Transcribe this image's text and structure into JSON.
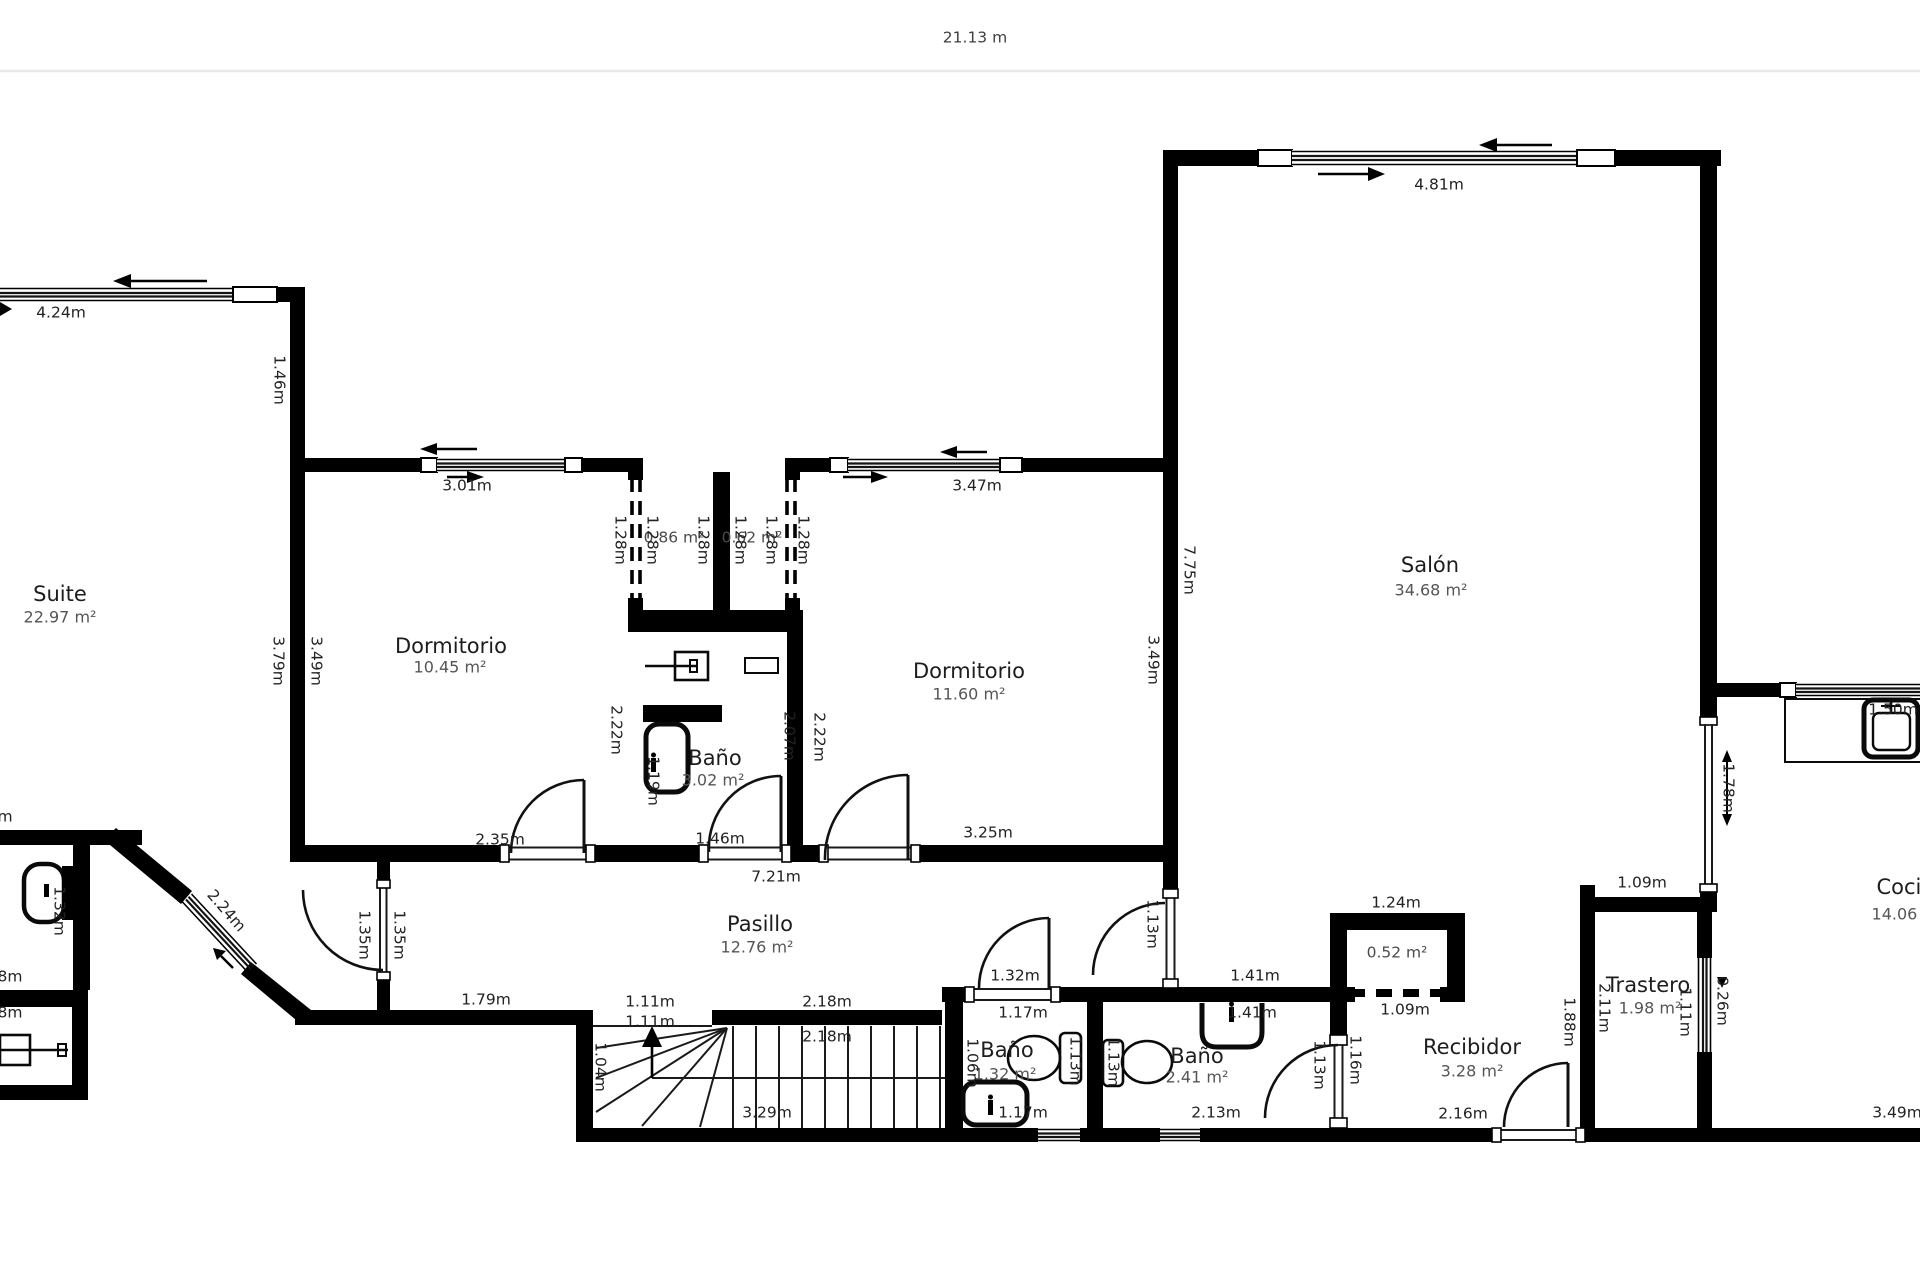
{
  "ruler": {
    "label": "21.13 m"
  },
  "colors": {
    "wall": "#000000",
    "background": "#ffffff",
    "dimension_text": "#222222",
    "area_text": "#555555",
    "ruler_line": "#e8e8e8"
  },
  "rooms": [
    {
      "name": "Suite",
      "area": "22.97 m²",
      "nx": 60,
      "ny": 595,
      "ax": 60,
      "ay": 618
    },
    {
      "name": "Dormitorio",
      "area": "10.45 m²",
      "nx": 451,
      "ny": 647,
      "ax": 450,
      "ay": 668
    },
    {
      "name": "Baño",
      "area": "3.02 m²",
      "nx": 715,
      "ny": 759,
      "ax": 713,
      "ay": 781
    },
    {
      "name": "Dormitorio",
      "area": "11.60 m²",
      "nx": 969,
      "ny": 672,
      "ax": 969,
      "ay": 695
    },
    {
      "name": "Salón",
      "area": "34.68 m²",
      "nx": 1430,
      "ny": 566,
      "ax": 1431,
      "ay": 591
    },
    {
      "name": "Pasillo",
      "area": "12.76 m²",
      "nx": 760,
      "ny": 925,
      "ax": 757,
      "ay": 948
    },
    {
      "name": "Baño",
      "area": "1.32 m²",
      "nx": 1007,
      "ny": 1051,
      "ax": 1005,
      "ay": 1075
    },
    {
      "name": "Baño",
      "area": "2.41 m²",
      "nx": 1197,
      "ny": 1057,
      "ax": 1197,
      "ay": 1078
    },
    {
      "name": "Recibidor",
      "area": "3.28 m²",
      "nx": 1472,
      "ny": 1048,
      "ax": 1472,
      "ay": 1072
    },
    {
      "name": "Trastero",
      "area": "1.98 m²",
      "nx": 1648,
      "ny": 986,
      "ax": 1650,
      "ay": 1009
    },
    {
      "name": "Cocina",
      "area": "14.06 m²",
      "nx": 1912,
      "ny": 888,
      "ax": 1908,
      "ay": 915
    }
  ],
  "closet_areas": [
    {
      "t": "0.86 m²",
      "x": 674,
      "y": 538
    },
    {
      "t": "0.62 m²",
      "x": 752,
      "y": 538
    },
    {
      "t": "0.52 m²",
      "x": 1397,
      "y": 953
    }
  ],
  "dimensions": [
    {
      "t": "4.24m",
      "x": 61,
      "y": 313
    },
    {
      "t": "3.01m",
      "x": 467,
      "y": 486
    },
    {
      "t": "3.47m",
      "x": 977,
      "y": 486
    },
    {
      "t": "4.81m",
      "x": 1439,
      "y": 185
    },
    {
      "t": "2.35m",
      "x": 500,
      "y": 840
    },
    {
      "t": "1.46m",
      "x": 720,
      "y": 839
    },
    {
      "t": "3.25m",
      "x": 988,
      "y": 833
    },
    {
      "t": "7.21m",
      "x": 776,
      "y": 877
    },
    {
      "t": "1.79m",
      "x": 486,
      "y": 1000
    },
    {
      "t": "1.11m",
      "x": 650,
      "y": 1002
    },
    {
      "t": "1.11m",
      "x": 650,
      "y": 1022
    },
    {
      "t": "2.18m",
      "x": 827,
      "y": 1002
    },
    {
      "t": "2.18m",
      "x": 827,
      "y": 1037
    },
    {
      "t": "3.29m",
      "x": 767,
      "y": 1113
    },
    {
      "t": "1.32m",
      "x": 1015,
      "y": 976
    },
    {
      "t": "1.17m",
      "x": 1023,
      "y": 1013
    },
    {
      "t": "1.17m",
      "x": 1023,
      "y": 1113
    },
    {
      "t": "1.41m",
      "x": 1255,
      "y": 976
    },
    {
      "t": "1.41m",
      "x": 1252,
      "y": 1013
    },
    {
      "t": "2.13m",
      "x": 1216,
      "y": 1113
    },
    {
      "t": "1.24m",
      "x": 1396,
      "y": 903
    },
    {
      "t": "1.09m",
      "x": 1405,
      "y": 1010
    },
    {
      "t": "2.16m",
      "x": 1463,
      "y": 1114
    },
    {
      "t": "1.09m",
      "x": 1642,
      "y": 883
    },
    {
      "t": "3.49m",
      "x": 1897,
      "y": 1113
    },
    {
      "t": "1.50m",
      "x": 1893,
      "y": 710
    },
    {
      "t": "1.46m",
      "x": 279,
      "y": 380,
      "r": 90
    },
    {
      "t": "3.79m",
      "x": 278,
      "y": 661,
      "r": 90
    },
    {
      "t": "3.49m",
      "x": 316,
      "y": 661,
      "r": 90
    },
    {
      "t": "1.28m",
      "x": 620,
      "y": 540,
      "r": 90
    },
    {
      "t": "1.28m",
      "x": 652,
      "y": 540,
      "r": 90
    },
    {
      "t": "1.28m",
      "x": 703,
      "y": 540,
      "r": 90
    },
    {
      "t": "1.28m",
      "x": 740,
      "y": 540,
      "r": 90
    },
    {
      "t": "1.28m",
      "x": 771,
      "y": 540,
      "r": 90
    },
    {
      "t": "1.28m",
      "x": 803,
      "y": 540,
      "r": 90
    },
    {
      "t": "7.75m",
      "x": 1189,
      "y": 570,
      "r": 90
    },
    {
      "t": "3.49m",
      "x": 1153,
      "y": 660,
      "r": 90
    },
    {
      "t": "2.22m",
      "x": 616,
      "y": 730,
      "r": 90
    },
    {
      "t": "1.19m",
      "x": 653,
      "y": 781,
      "r": 90
    },
    {
      "t": "2.07m",
      "x": 789,
      "y": 736,
      "r": 90
    },
    {
      "t": "2.22m",
      "x": 819,
      "y": 737,
      "r": 90
    },
    {
      "t": "1.35m",
      "x": 364,
      "y": 935,
      "r": 90
    },
    {
      "t": "1.35m",
      "x": 399,
      "y": 935,
      "r": 90
    },
    {
      "t": "1.32m",
      "x": 59,
      "y": 911,
      "r": 90
    },
    {
      "t": "1.04m",
      "x": 600,
      "y": 1067,
      "r": 90
    },
    {
      "t": "1.13m",
      "x": 1152,
      "y": 924,
      "r": 90
    },
    {
      "t": "1.13m",
      "x": 1075,
      "y": 1061,
      "r": 90
    },
    {
      "t": "1.13m",
      "x": 1113,
      "y": 1062,
      "r": 90
    },
    {
      "t": "1.06m",
      "x": 972,
      "y": 1063,
      "r": 90
    },
    {
      "t": "1.13m",
      "x": 1319,
      "y": 1065,
      "r": 90
    },
    {
      "t": "1.16m",
      "x": 1355,
      "y": 1060,
      "r": 90
    },
    {
      "t": "1.88m",
      "x": 1569,
      "y": 1022,
      "r": 90
    },
    {
      "t": "2.11m",
      "x": 1604,
      "y": 1008,
      "r": 90
    },
    {
      "t": "1.11m",
      "x": 1685,
      "y": 1012,
      "r": 90
    },
    {
      "t": "0.26m",
      "x": 1722,
      "y": 1001,
      "r": 90
    },
    {
      "t": "1.78m",
      "x": 1728,
      "y": 788,
      "r": 90
    },
    {
      "t": "2.24m",
      "x": 226,
      "y": 911,
      "r": 49
    }
  ],
  "partial_labels": [
    {
      "t": "m",
      "x": 5,
      "y": 817
    },
    {
      "t": "8m",
      "x": 10,
      "y": 977
    },
    {
      "t": "8m",
      "x": 10,
      "y": 1013
    }
  ]
}
